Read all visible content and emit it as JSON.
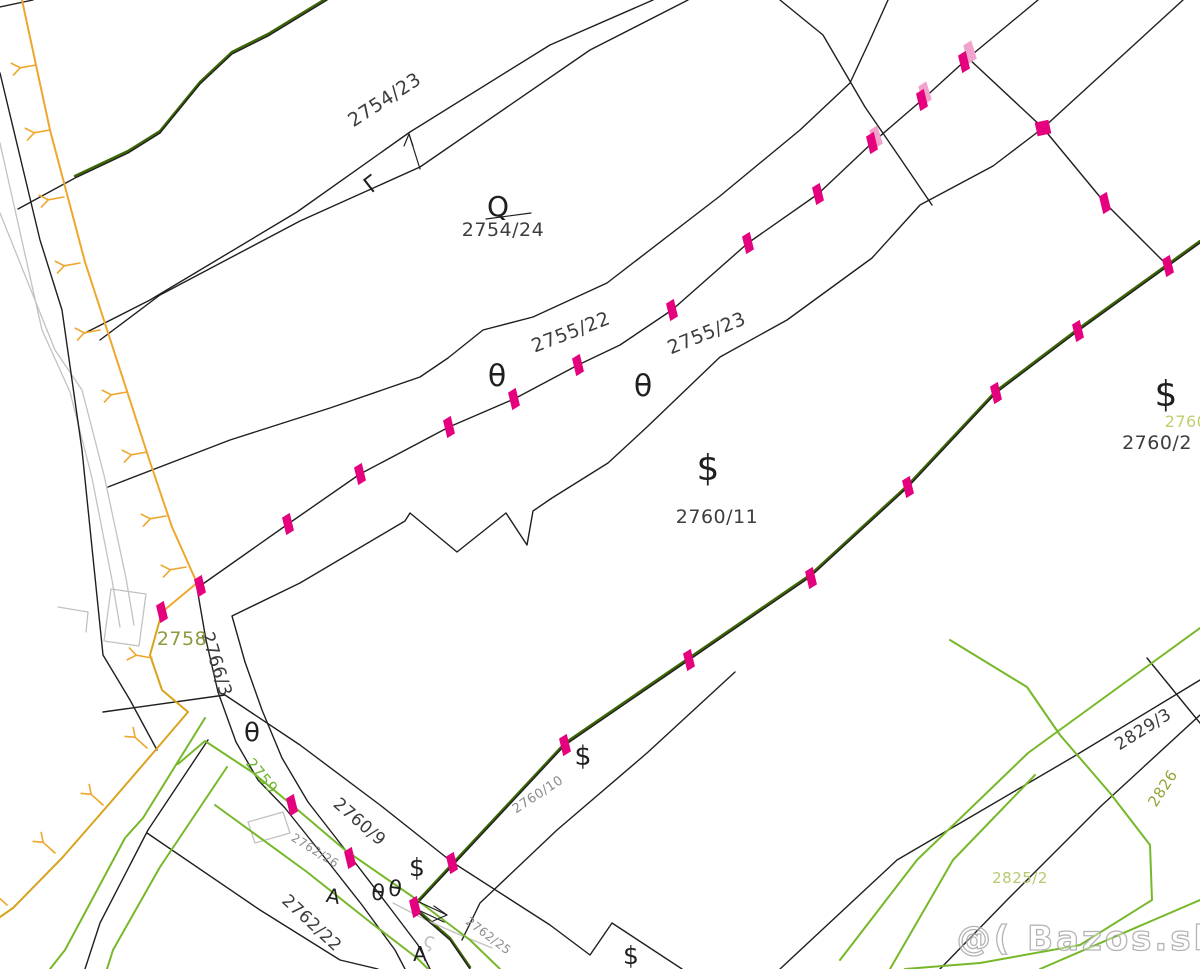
{
  "map": {
    "width": 1200,
    "height": 969,
    "background": "#ffffff",
    "colors": {
      "black": "#1f1f1f",
      "gray": "#c2c2c2",
      "orange": "#efa62d",
      "mustard": "#d8a41e",
      "green": "#76b82a",
      "darkgreen": "#3b6604",
      "magenta": "#e5007e",
      "palepink": "#f1a3cd",
      "label_dark": "#3d3d3d",
      "label_gray": "#8c8c8c",
      "label_olive": "#8a9b40",
      "label_brightgreen": "#6fb52c",
      "label_palegreen": "#b3cb6d",
      "label_yellowgreen": "#bdd06e",
      "label_olive2": "#97a437"
    },
    "watermark": {
      "text": "@( Bazos.sk",
      "x": 1088,
      "y": 950,
      "size": 34
    },
    "parcel_labels": [
      {
        "text": "2754/23",
        "x": 388,
        "y": 105,
        "rot": -33,
        "size": 19,
        "color": "label_dark"
      },
      {
        "text": "2754/24",
        "x": 503,
        "y": 236,
        "rot": 0,
        "size": 19,
        "color": "label_dark"
      },
      {
        "text": "2755/22",
        "x": 573,
        "y": 338,
        "rot": -21,
        "size": 19,
        "color": "label_dark"
      },
      {
        "text": "2755/23",
        "x": 709,
        "y": 339,
        "rot": -22,
        "size": 19,
        "color": "label_dark"
      },
      {
        "text": "2760/11",
        "x": 717,
        "y": 523,
        "rot": 0,
        "size": 19,
        "color": "label_dark"
      },
      {
        "text": "2760/2",
        "x": 1157,
        "y": 449,
        "rot": 0,
        "size": 19,
        "color": "label_dark"
      },
      {
        "text": "2760",
        "x": 1186,
        "y": 427,
        "rot": 0,
        "size": 16,
        "color": "label_yellowgreen"
      },
      {
        "text": "2766/3",
        "x": 211,
        "y": 666,
        "rot": 73,
        "size": 18,
        "color": "label_dark"
      },
      {
        "text": "2758",
        "x": 182,
        "y": 645,
        "rot": 0,
        "size": 19,
        "color": "label_olive"
      },
      {
        "text": "2759",
        "x": 258,
        "y": 779,
        "rot": 50,
        "size": 15,
        "color": "label_brightgreen"
      },
      {
        "text": "2760/9",
        "x": 356,
        "y": 826,
        "rot": 41,
        "size": 17,
        "color": "label_dark"
      },
      {
        "text": "2760/10",
        "x": 540,
        "y": 798,
        "rot": -33,
        "size": 13,
        "color": "label_gray"
      },
      {
        "text": "2762/26",
        "x": 313,
        "y": 854,
        "rot": 32,
        "size": 12,
        "color": "label_gray"
      },
      {
        "text": "2762/22",
        "x": 308,
        "y": 927,
        "rot": 43,
        "size": 17,
        "color": "label_dark"
      },
      {
        "text": "2762/25",
        "x": 486,
        "y": 939,
        "rot": 37,
        "size": 12,
        "color": "label_gray"
      },
      {
        "text": "2829/3",
        "x": 1146,
        "y": 734,
        "rot": -32,
        "size": 17,
        "color": "label_dark"
      },
      {
        "text": "2826",
        "x": 1167,
        "y": 791,
        "rot": -57,
        "size": 15,
        "color": "label_olive2"
      },
      {
        "text": "2825/2",
        "x": 1020,
        "y": 883,
        "rot": 0,
        "size": 15,
        "color": "label_palegreen"
      }
    ],
    "symbols": [
      {
        "glyph": "θ",
        "x": 497,
        "y": 386,
        "rot": 0,
        "size": 30,
        "color": "black",
        "name": "theta-symbol"
      },
      {
        "glyph": "θ",
        "x": 643,
        "y": 396,
        "rot": 0,
        "size": 30,
        "color": "black",
        "name": "theta-symbol"
      },
      {
        "glyph": "θ",
        "x": 252,
        "y": 741,
        "rot": 0,
        "size": 26,
        "color": "black",
        "name": "theta-symbol"
      },
      {
        "glyph": "θ",
        "x": 377,
        "y": 900,
        "rot": 8,
        "size": 22,
        "color": "black",
        "name": "theta-symbol"
      },
      {
        "glyph": "θ",
        "x": 394,
        "y": 896,
        "rot": 8,
        "size": 22,
        "color": "black",
        "name": "theta-symbol"
      },
      {
        "glyph": "$",
        "x": 708,
        "y": 480,
        "rot": 0,
        "size": 36,
        "color": "black",
        "name": "dollar-symbol"
      },
      {
        "glyph": "$",
        "x": 1166,
        "y": 406,
        "rot": 0,
        "size": 36,
        "color": "black",
        "name": "dollar-symbol"
      },
      {
        "glyph": "$",
        "x": 583,
        "y": 765,
        "rot": 0,
        "size": 27,
        "color": "black",
        "name": "dollar-symbol"
      },
      {
        "glyph": "$",
        "x": 417,
        "y": 876,
        "rot": 0,
        "size": 25,
        "color": "black",
        "name": "dollar-symbol"
      },
      {
        "glyph": "$",
        "x": 631,
        "y": 964,
        "rot": 0,
        "size": 25,
        "color": "black",
        "name": "dollar-symbol"
      },
      {
        "glyph": "Q",
        "x": 498,
        "y": 216,
        "rot": 0,
        "size": 28,
        "color": "black",
        "name": "q-symbol"
      },
      {
        "glyph": "Γ",
        "x": 376,
        "y": 190,
        "rot": -38,
        "size": 22,
        "color": "black",
        "name": "gamma-symbol"
      },
      {
        "glyph": "A",
        "x": 332,
        "y": 903,
        "rot": 10,
        "size": 20,
        "color": "black",
        "name": "a-symbol"
      },
      {
        "glyph": "A",
        "x": 420,
        "y": 961,
        "rot": 0,
        "size": 20,
        "color": "black",
        "name": "a-symbol"
      },
      {
        "glyph": "ς",
        "x": 428,
        "y": 947,
        "rot": 15,
        "size": 20,
        "color": "gray",
        "name": "squiggle-symbol"
      }
    ],
    "lines": [
      {
        "name": "dark-green-overlay",
        "color": "darkgreen",
        "width": 2.4,
        "points": "327,-2 268,34 232,52 200,82 160,131 128,151 75,176"
      },
      {
        "name": "dark-green-overlay",
        "color": "darkgreen",
        "width": 2.4,
        "points": "1200,241 1078,329 996,391 908,485 810,575 689,658 565,743 413,906 450,938 470,967"
      },
      {
        "name": "road-edge-gray",
        "color": "gray",
        "width": 1.3,
        "points": "0,143 42,330 70,392 92,478 112,580 120,627"
      },
      {
        "name": "road-edge-gray",
        "color": "gray",
        "width": 1.3,
        "points": "0,213 55,350 82,390 104,475 126,578 134,625"
      },
      {
        "name": "building-outline-gray",
        "color": "gray",
        "width": 1.3,
        "points": "111,589 146,594 139,646 104,641 111,589"
      },
      {
        "name": "building-outline-gray",
        "color": "gray",
        "width": 1.3,
        "points": "248,822 283,812 290,833 255,843 248,822"
      },
      {
        "name": "road-detail-gray",
        "color": "gray",
        "width": 1.3,
        "points": "393,903 426,920 458,934 492,948"
      },
      {
        "name": "road-detail-gray",
        "color": "gray",
        "width": 1.3,
        "points": "58,607 88,612 86,632"
      },
      {
        "name": "parcel-boundary",
        "color": "black",
        "width": 1.4,
        "points": "0,73 40,240 62,310 82,450 103,655 130,700 157,750"
      },
      {
        "name": "parcel-boundary",
        "color": "black",
        "width": 1.4,
        "points": "0,7 33,0"
      },
      {
        "name": "parcel-boundary",
        "color": "black",
        "width": 1.4,
        "points": "327,0 268,36 232,54 200,84 160,133 128,153 75,178 18,209"
      },
      {
        "name": "parcel-boundary",
        "color": "black",
        "width": 1.4,
        "points": "653,0 550,45 410,132 297,212 150,300 85,333"
      },
      {
        "name": "parcel-boundary",
        "color": "black",
        "width": 1.4,
        "points": "688,0 590,50 420,167 300,221 160,295 100,340"
      },
      {
        "name": "parcel-boundary",
        "color": "black",
        "width": 1.4,
        "points": "888,0 870,40 850,83 800,130 720,196 607,283 533,317 483,330 448,358 420,377 330,408 230,440 108,487"
      },
      {
        "name": "parcel-boundary-marked",
        "color": "black",
        "width": 1.4,
        "points": "200,586 288,524 360,474 449,427 514,399 578,365 620,345 672,310 748,243 818,194 872,143 922,100 968,58 1038,0"
      },
      {
        "name": "parcel-boundary",
        "color": "black",
        "width": 1.4,
        "points": "780,0 823,35 865,107 900,158 932,205"
      },
      {
        "name": "parcel-boundary",
        "color": "black",
        "width": 1.4,
        "points": "968,58 1043,128"
      },
      {
        "name": "parcel-boundary",
        "color": "black",
        "width": 1.4,
        "points": "1183,0 1043,128 993,166 920,205 872,258 787,320 720,357 647,427 608,463 552,498 533,511 527,545 506,513 457,552 410,513 405,521 300,583 232,616 245,662 262,710 282,758 308,802 350,856 390,908 418,945 430,969"
      },
      {
        "name": "parcel-boundary",
        "color": "black",
        "width": 1.4,
        "points": "1043,128 1105,203 1168,266"
      },
      {
        "name": "parcel-boundary-marked",
        "color": "black",
        "width": 1.4,
        "points": "1200,243 1078,331 996,393 908,487 810,577 689,660 565,745 413,908 450,940 470,969"
      },
      {
        "name": "parcel-boundary",
        "color": "black",
        "width": 1.4,
        "points": "197,588 206,640 218,692 236,742 258,780 285,808 325,858 362,905 395,950 405,969"
      },
      {
        "name": "parcel-boundary",
        "color": "black",
        "width": 1.4,
        "points": "103,712 225,695"
      },
      {
        "name": "parcel-boundary",
        "color": "black",
        "width": 1.4,
        "points": "225,695 300,745 380,805 452,862"
      },
      {
        "name": "parcel-boundary",
        "color": "black",
        "width": 1.4,
        "points": "452,862 550,925 590,955 612,923 682,969"
      },
      {
        "name": "parcel-boundary",
        "color": "black",
        "width": 1.4,
        "points": "147,833 260,910 340,960 378,969"
      },
      {
        "name": "parcel-boundary",
        "color": "black",
        "width": 1.4,
        "points": "208,740 148,830 100,923 85,969"
      },
      {
        "name": "parcel-boundary",
        "color": "black",
        "width": 1.4,
        "points": "780,969 897,860 1073,757 1200,680"
      },
      {
        "name": "parcel-boundary",
        "color": "black",
        "width": 1.4,
        "points": "940,969 1007,900 1100,807 1200,715"
      },
      {
        "name": "parcel-boundary",
        "color": "black",
        "width": 1.4,
        "points": "1147,658 1200,723"
      },
      {
        "name": "parcel-boundary",
        "color": "black",
        "width": 1.4,
        "points": "462,940 480,903 557,830 647,753 735,672"
      },
      {
        "name": "utility-line-green",
        "color": "green",
        "width": 2,
        "points": "205,718 143,818 125,838 65,950 50,969"
      },
      {
        "name": "utility-line-green",
        "color": "green",
        "width": 2,
        "points": "178,764 205,741 252,772 292,805 345,850 413,897 470,940 500,969"
      },
      {
        "name": "utility-line-green",
        "color": "green",
        "width": 2,
        "points": "227,767 160,867 113,950 107,969"
      },
      {
        "name": "utility-line-green",
        "color": "green",
        "width": 2,
        "points": "215,805 307,872 370,922 417,958 428,969"
      },
      {
        "name": "utility-line-green",
        "color": "green",
        "width": 2,
        "points": "840,960 917,860 1028,753 1200,628"
      },
      {
        "name": "utility-line-green",
        "color": "green",
        "width": 2,
        "points": "950,640 1027,687 1060,735 1110,793 1150,845 1152,900 1080,945 980,963 905,969"
      },
      {
        "name": "utility-line-green",
        "color": "green",
        "width": 2,
        "points": "1040,969 1200,900"
      },
      {
        "name": "utility-line-green",
        "color": "green",
        "width": 2,
        "points": "890,969 953,860 1035,775"
      },
      {
        "name": "boundary-line-orange",
        "color": "orange",
        "width": 2,
        "points": "22,0 50,130 85,262 125,385 150,462 172,527 197,583 162,612"
      },
      {
        "name": "boundary-line-orange",
        "color": "mustard",
        "width": 2,
        "points": "162,612 150,655 162,690 188,712 153,753 110,803 62,858 13,908 0,917"
      },
      {
        "name": "q-symbol-underline",
        "color": "black",
        "width": 1.2,
        "points": "486,219 531,213"
      },
      {
        "name": "north-arrow-shaft",
        "color": "black",
        "width": 1.2,
        "points": "420,169 409,134"
      },
      {
        "name": "north-arrow-head",
        "color": "black",
        "width": 1.2,
        "points": "404,146 409,134 413,146"
      },
      {
        "name": "direction-arrow-shaft",
        "color": "black",
        "width": 1.2,
        "points": "417,901 447,915"
      },
      {
        "name": "direction-arrow-shaft",
        "color": "black",
        "width": 1.2,
        "points": "414,908 444,922"
      },
      {
        "name": "direction-arrow-head",
        "color": "black",
        "width": 1.2,
        "points": "434,906 447,915 433,921"
      }
    ],
    "markers": [
      {
        "x": 200,
        "y": 586
      },
      {
        "x": 162,
        "y": 612
      },
      {
        "x": 288,
        "y": 524
      },
      {
        "x": 360,
        "y": 474
      },
      {
        "x": 449,
        "y": 427
      },
      {
        "x": 514,
        "y": 399
      },
      {
        "x": 578,
        "y": 365
      },
      {
        "x": 672,
        "y": 310
      },
      {
        "x": 748,
        "y": 243
      },
      {
        "x": 818,
        "y": 194
      },
      {
        "x": 872,
        "y": 143
      },
      {
        "x": 922,
        "y": 100
      },
      {
        "x": 964,
        "y": 62
      },
      {
        "x": 1043,
        "y": 128,
        "type": "square"
      },
      {
        "x": 1105,
        "y": 203
      },
      {
        "x": 1168,
        "y": 266
      },
      {
        "x": 1078,
        "y": 331
      },
      {
        "x": 996,
        "y": 393
      },
      {
        "x": 908,
        "y": 487
      },
      {
        "x": 811,
        "y": 578
      },
      {
        "x": 689,
        "y": 660
      },
      {
        "x": 565,
        "y": 745
      },
      {
        "x": 292,
        "y": 805
      },
      {
        "x": 350,
        "y": 858
      },
      {
        "x": 452,
        "y": 863
      },
      {
        "x": 415,
        "y": 907
      }
    ],
    "pale_markers": [
      {
        "x": 970,
        "y": 52
      },
      {
        "x": 925,
        "y": 93
      },
      {
        "x": 876,
        "y": 137
      }
    ],
    "ticks": [
      {
        "x": 36,
        "y": 65,
        "angle": 170
      },
      {
        "x": 50,
        "y": 130,
        "angle": 170
      },
      {
        "x": 64,
        "y": 197,
        "angle": 170
      },
      {
        "x": 80,
        "y": 263,
        "angle": 170
      },
      {
        "x": 100,
        "y": 330,
        "angle": 170
      },
      {
        "x": 127,
        "y": 392,
        "angle": 170
      },
      {
        "x": 147,
        "y": 452,
        "angle": 170
      },
      {
        "x": 166,
        "y": 516,
        "angle": 170
      },
      {
        "x": 186,
        "y": 567,
        "angle": 170
      },
      {
        "x": 152,
        "y": 658,
        "angle": 190
      },
      {
        "x": 147,
        "y": 748,
        "angle": 222
      },
      {
        "x": 103,
        "y": 805,
        "angle": 222
      },
      {
        "x": 55,
        "y": 853,
        "angle": 222
      },
      {
        "x": 7,
        "y": 905,
        "angle": 222
      }
    ]
  }
}
